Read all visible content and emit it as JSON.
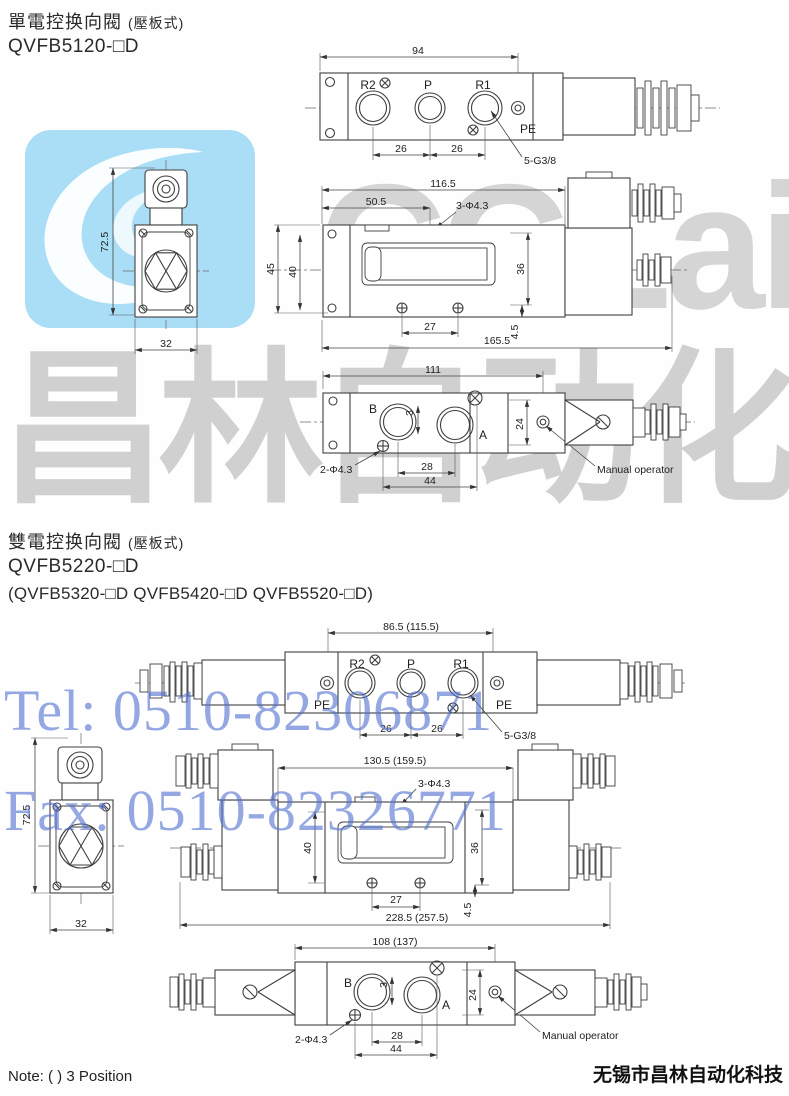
{
  "watermark": {
    "logo_text": "CCLair",
    "brand_large": "昌林自动化",
    "tel": "Tel: 0510-82306871",
    "fax": "Fax: 0510-82326771"
  },
  "footer": {
    "note": "Note: ( ) 3 Position",
    "company": "无锡市昌林自动化科技"
  },
  "section1": {
    "title": "單電控换向閥",
    "title_paren": "(壓板式)",
    "model": "QVFB5120-□D",
    "top_view": {
      "dim_total": "94",
      "port_r2": "R2",
      "port_p": "P",
      "port_r1": "R1",
      "pe": "PE",
      "dim_left": "26",
      "dim_right": "26",
      "thread": "5-G3/8"
    },
    "front_view": {
      "dim_height": "72.5",
      "dim_width": "32"
    },
    "side_view": {
      "dim_top": "116.5",
      "dim_top2": "50.5",
      "hole": "3-Φ4.3",
      "dim_h1": "45",
      "dim_h2": "40",
      "dim_h3": "36",
      "dim_b1": "27",
      "dim_b2": "4.5",
      "dim_total": "165.5"
    },
    "bottom_view": {
      "dim_total": "111",
      "port_b": "B",
      "port_a": "A",
      "dim_small": "3",
      "dim_h": "24",
      "hole": "2-Φ4.3",
      "dim_b1": "28",
      "dim_b2": "44",
      "manual": "Manual operator"
    }
  },
  "section2": {
    "title": "雙電控换向閥",
    "title_paren": "(壓板式)",
    "model": "QVFB5220-□D",
    "models_alt": "(QVFB5320-□D  QVFB5420-□D  QVFB5520-□D)",
    "top_view": {
      "dim_total": "86.5 (115.5)",
      "port_r2": "R2",
      "port_p": "P",
      "port_r1": "R1",
      "pe_left": "PE",
      "pe_right": "PE",
      "dim_left": "26",
      "dim_right": "26",
      "thread": "5-G3/8"
    },
    "front_view": {
      "dim_height": "72.5",
      "dim_width": "32"
    },
    "side_view": {
      "dim_top": "130.5 (159.5)",
      "hole": "3-Φ4.3",
      "dim_h1": "40",
      "dim_h2": "36",
      "dim_b1": "27",
      "dim_b2": "4.5",
      "dim_total": "228.5 (257.5)"
    },
    "bottom_view": {
      "dim_total": "108 (137)",
      "port_b": "B",
      "port_a": "A",
      "dim_small": "3",
      "dim_h": "24",
      "hole": "2-Φ4.3",
      "dim_b1": "28",
      "dim_b2": "44",
      "manual": "Manual operator"
    }
  }
}
